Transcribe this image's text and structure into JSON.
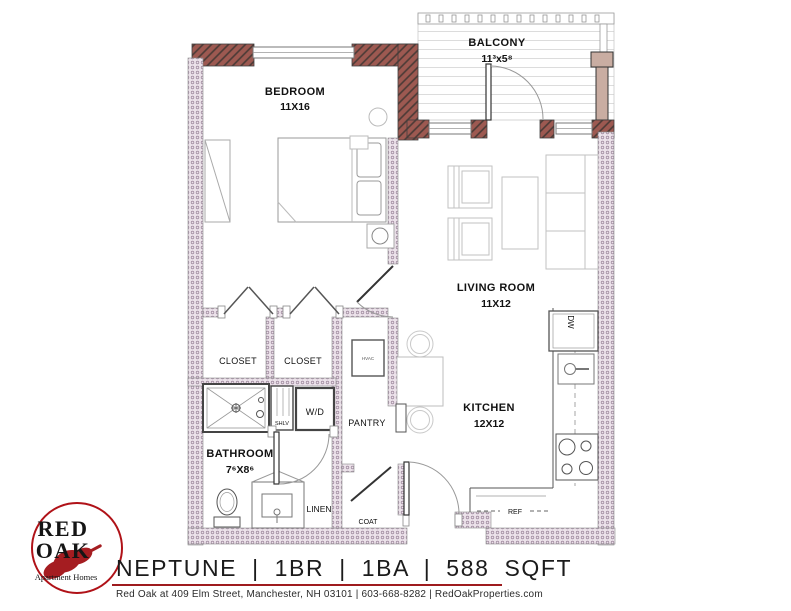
{
  "plan": {
    "rooms": {
      "bedroom": {
        "name": "BEDROOM",
        "dims": "11X16"
      },
      "balcony": {
        "name": "BALCONY",
        "dims": "11³x5⁸"
      },
      "living": {
        "name": "LIVING ROOM",
        "dims": "11X12"
      },
      "kitchen": {
        "name": "KITCHEN",
        "dims": "12X12"
      },
      "bathroom": {
        "name": "BATHROOM",
        "dims": "7⁶X8⁶"
      }
    },
    "features": {
      "closet_left": "CLOSET",
      "closet_right": "CLOSET",
      "pantry": "PANTRY",
      "washer_dryer": "W/D",
      "shelves": "SHLV",
      "linen": "LINEN",
      "coat": "COAT",
      "fridge": "REF",
      "dishwasher": "DW",
      "hvac": "HVAC"
    }
  },
  "footer": {
    "logo": {
      "word1": "RED",
      "word2": "OAK",
      "tagline": "Apartment Homes"
    },
    "plan_title": "NEPTUNE | 1BR | 1BA | 588 SQFT",
    "address": "Red Oak at 409 Elm Street, Manchester, NH 03101 | 603-668-8282 | RedOakProperties.com"
  },
  "colors": {
    "brick": "#9d5951",
    "wall_pink": "#ece2ea",
    "logo_red": "#b01218",
    "rule_red": "#9e1b1e"
  }
}
